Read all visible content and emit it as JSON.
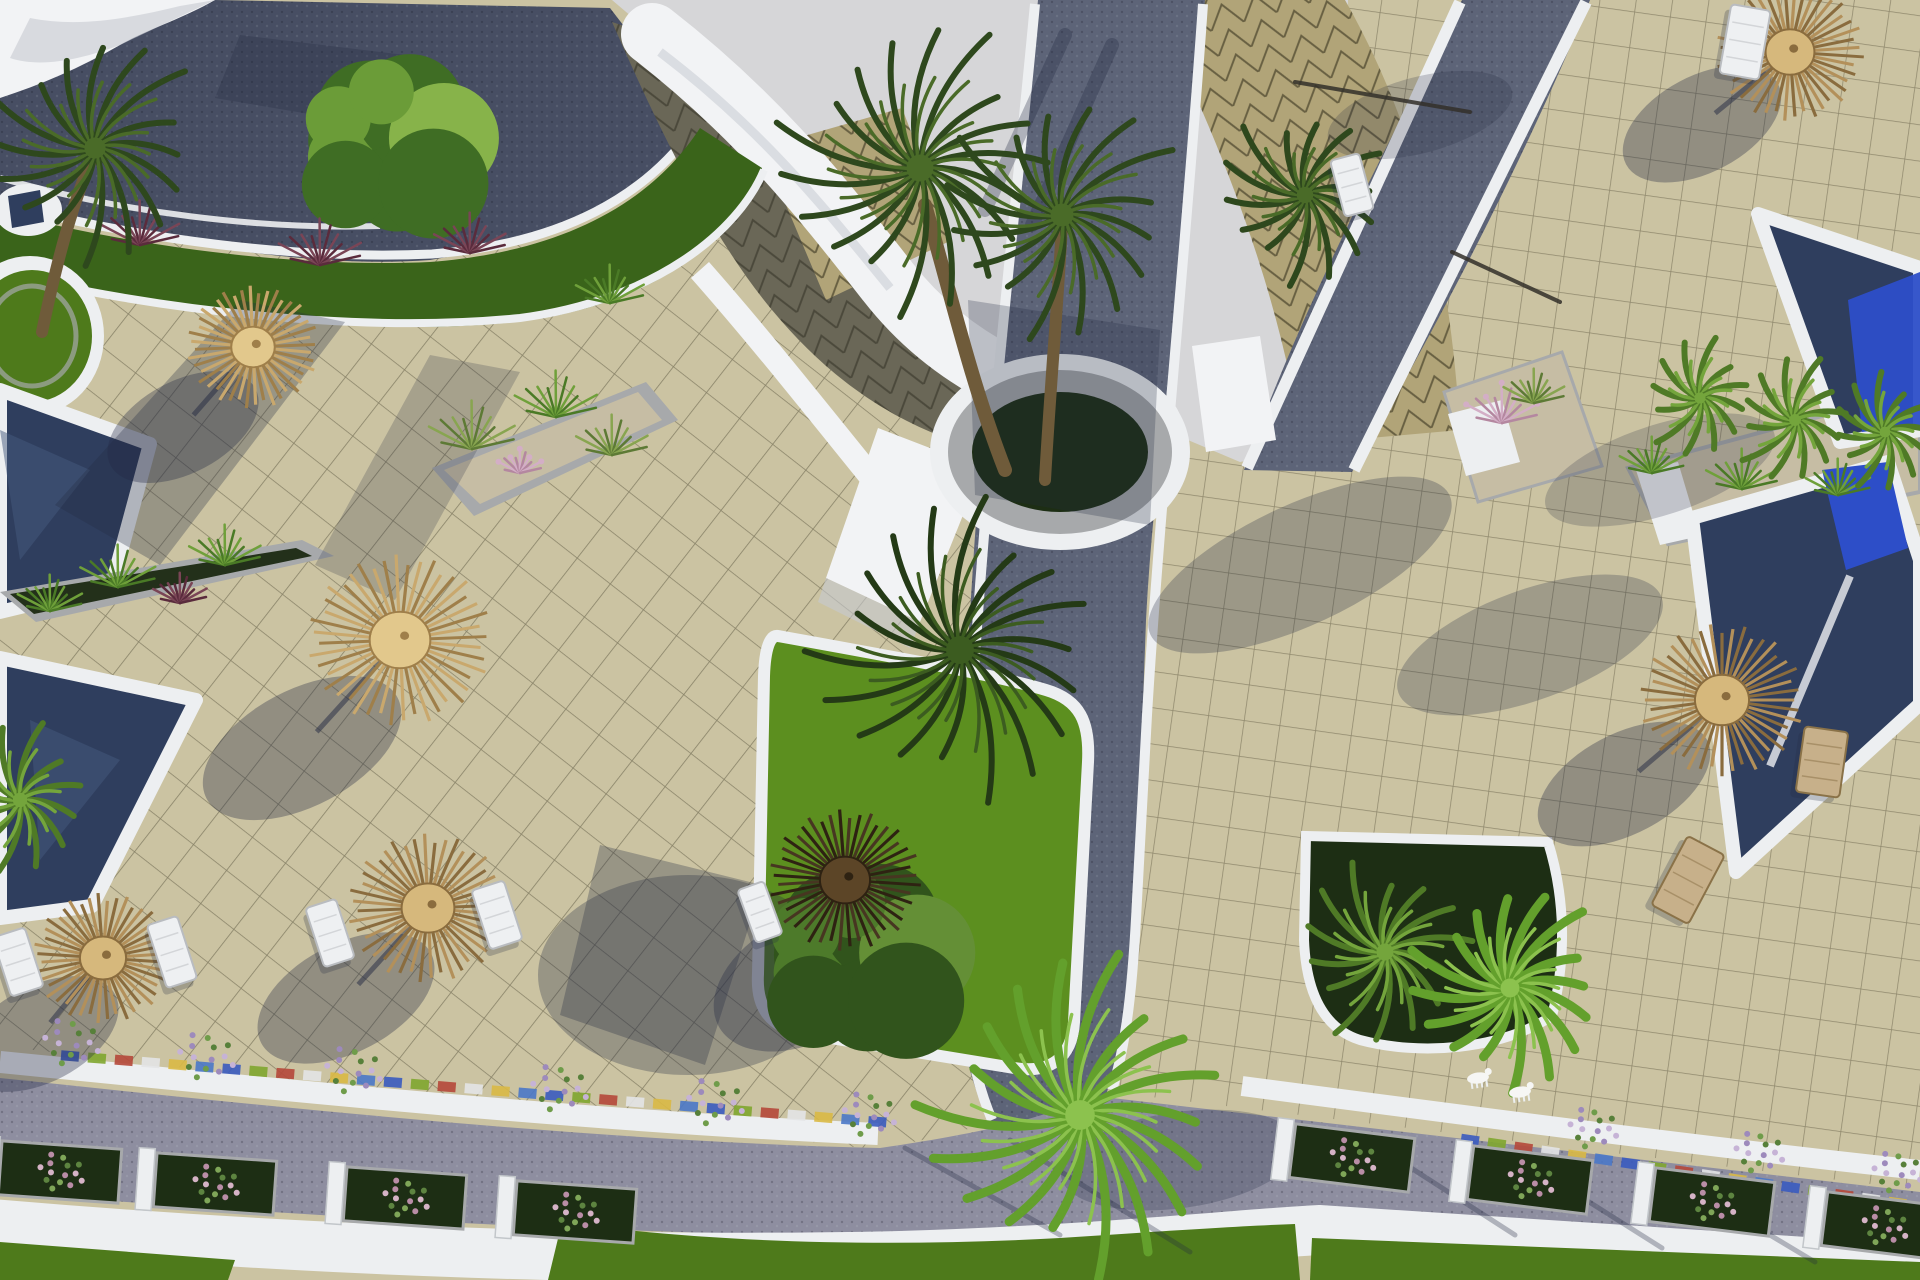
{
  "scene": {
    "description": "Aerial 3D architectural rendering of a resort: beige tiled pool terraces with thatched straw umbrellas and white sun loungers, navy swimming pools with white rims, curved white building roofs with tan triangle-patterned tiles, dark cobblestone pathways with white curbs, green lawns, planters with palms, ornamental grasses and flowering shrubs.",
    "palette": {
      "tile": "#cbc3a2",
      "sky": "#d6d6d8",
      "roadTop": "#474e63",
      "roadMid": "#5d6478",
      "roadLight": "#8e8ea0",
      "curb": "#edeff1",
      "whiteRoof": "#f2f3f5",
      "roofShade": "#c6cad1",
      "roofShadow": "#6a6757",
      "roofTan": "#b1a478",
      "stone": "#a7a9ab",
      "soil": "#23301a",
      "gravel": "#c6bda4",
      "lawn": "#4e7a1b",
      "lawnBright": "#5c8f1f",
      "grassStrip": "#3a641a",
      "bed": "#1d2e14",
      "poolNavy": "#2f3e5e",
      "poolBright": "#2d4ec8",
      "trunk": "#6f5b3a",
      "shadow": "#232a42"
    },
    "umbrella_tones": {
      "light": {
        "base": "#c9a86d",
        "alt": "#9f7f4a",
        "hub": "#e2c88c"
      },
      "mid": {
        "base": "#b3905a",
        "alt": "#8a6c3e",
        "hub": "#d6b87c"
      },
      "dark": {
        "base": "#473621",
        "alt": "#2e2212",
        "hub": "#5c4527"
      }
    },
    "umbrellas": [
      [
        253,
        347,
        66,
        "light",
        -70,
        80,
        82,
        46
      ],
      [
        400,
        640,
        92,
        "light",
        -98,
        108,
        108,
        58
      ],
      [
        103,
        958,
        70,
        "mid",
        -62,
        76,
        84,
        48
      ],
      [
        428,
        908,
        80,
        "mid",
        -82,
        90,
        96,
        54
      ],
      [
        845,
        880,
        76,
        "dark",
        -40,
        100,
        98,
        62
      ],
      [
        1790,
        52,
        74,
        "mid",
        -88,
        72,
        86,
        48
      ],
      [
        1722,
        700,
        82,
        "mid",
        -98,
        84,
        94,
        50
      ]
    ],
    "lounger_styles": {
      "white": {
        "fill": "#eef0f2",
        "stroke": "#b9bcc0"
      },
      "wood": {
        "fill": "#c7b08a",
        "stroke": "#8a7248"
      }
    },
    "loungers": [
      [
        18,
        962,
        34,
        62,
        -18,
        "white"
      ],
      [
        172,
        952,
        32,
        66,
        -18,
        "white"
      ],
      [
        330,
        933,
        32,
        62,
        -18,
        "white"
      ],
      [
        497,
        915,
        34,
        62,
        -18,
        "white"
      ],
      [
        760,
        912,
        28,
        56,
        -20,
        "white"
      ],
      [
        1352,
        185,
        30,
        58,
        -15,
        "white"
      ],
      [
        1745,
        42,
        40,
        70,
        10,
        "white"
      ],
      [
        1688,
        880,
        42,
        78,
        28,
        "wood"
      ],
      [
        1822,
        762,
        44,
        66,
        8,
        "wood"
      ]
    ],
    "palm_tones": {
      "dark": {
        "main": "#2e481d",
        "alt": "#4a6b28"
      },
      "deep": {
        "main": "#243a16",
        "alt": "#3c5c20"
      },
      "mid": {
        "main": "#4f7a26",
        "alt": "#74a53c"
      },
      "bright": {
        "main": "#63a02c",
        "alt": "#8cc24e"
      }
    },
    "palms": [
      [
        95,
        148,
        118,
        "dark",
        16
      ],
      [
        920,
        168,
        150,
        "dark",
        18
      ],
      [
        1062,
        215,
        128,
        "dark",
        16
      ],
      [
        1305,
        195,
        92,
        "dark",
        14
      ],
      [
        960,
        650,
        155,
        "deep",
        18
      ],
      [
        1080,
        1115,
        165,
        "bright",
        18
      ],
      [
        1385,
        952,
        95,
        "mid",
        14
      ],
      [
        1510,
        988,
        105,
        "bright",
        16
      ],
      [
        1700,
        398,
        62,
        "mid",
        12
      ],
      [
        1795,
        420,
        66,
        "mid",
        12
      ],
      [
        1885,
        432,
        60,
        "mid",
        12
      ],
      [
        20,
        800,
        80,
        "mid",
        12
      ]
    ],
    "trunks": [
      [
        "M1005,470 C970,380 950,290 925,205",
        14
      ],
      [
        "M1045,480 C1050,390 1058,300 1062,225",
        12
      ],
      [
        "M42,332 C55,270 70,210 92,158",
        12
      ]
    ],
    "tree_tones": {
      "mid": {
        "main": "#3f6d24",
        "alt": "#6b9c38",
        "hi": "#87b34a"
      },
      "deep": {
        "main": "#31541c",
        "alt": "#4d7a2a",
        "hi": "#648f36"
      }
    },
    "trees": [
      [
        385,
        145,
        125,
        "mid"
      ],
      [
        855,
        960,
        132,
        "deep"
      ]
    ],
    "tuft_colors": {
      "grass": [
        "#4a7a26",
        "#6fa03a"
      ],
      "reed": [
        "#5d7a35",
        "#88a550"
      ],
      "red": [
        "#5a2b3c",
        "#7a4556"
      ],
      "pink": [
        "#b487a0",
        "#d3aec6"
      ]
    },
    "tufts": [
      [
        118,
        584,
        42,
        "grass"
      ],
      [
        225,
        562,
        40,
        "grass"
      ],
      [
        50,
        608,
        36,
        "grass"
      ],
      [
        180,
        600,
        30,
        "red"
      ],
      [
        472,
        446,
        48,
        "reed"
      ],
      [
        556,
        414,
        46,
        "grass"
      ],
      [
        612,
        452,
        40,
        "reed"
      ],
      [
        520,
        470,
        24,
        "pink"
      ],
      [
        140,
        242,
        44,
        "red"
      ],
      [
        320,
        262,
        46,
        "red"
      ],
      [
        470,
        250,
        40,
        "red"
      ],
      [
        610,
        300,
        38,
        "grass"
      ],
      [
        1652,
        470,
        36,
        "grass"
      ],
      [
        1742,
        486,
        40,
        "grass"
      ],
      [
        1838,
        492,
        36,
        "grass"
      ],
      [
        1502,
        420,
        40,
        "pink"
      ],
      [
        1534,
        400,
        34,
        "reed"
      ]
    ],
    "flower_palette": [
      "#9d8abc",
      "#c6b3d6",
      "#57803a",
      "#6f9c4a"
    ],
    "flower_clusters": [
      [
        70,
        1042,
        30
      ],
      [
        205,
        1056,
        30
      ],
      [
        352,
        1070,
        30
      ],
      [
        558,
        1088,
        30
      ],
      [
        714,
        1102,
        30
      ],
      [
        868,
        1114,
        28
      ],
      [
        1592,
        1128,
        26
      ],
      [
        1758,
        1152,
        26
      ],
      [
        1896,
        1172,
        26
      ]
    ],
    "box_flower_palette": [
      "#b98da6",
      "#d5b3c6",
      "#5d8440",
      "#7fa658"
    ],
    "box_planters": {
      "left": [
        [
          60,
          1172
        ],
        [
          215,
          1184
        ],
        [
          405,
          1198
        ],
        [
          575,
          1212
        ]
      ],
      "left_rot": 4,
      "right": [
        [
          1352,
          1158
        ],
        [
          1530,
          1180
        ],
        [
          1712,
          1202
        ],
        [
          1884,
          1226
        ]
      ],
      "right_rot": 7,
      "box": [
        120,
        54
      ]
    },
    "mosaic": {
      "bands": [
        [
          70,
          1056,
          880,
          1122
        ],
        [
          1470,
          1140,
          1918,
          1206
        ]
      ],
      "colors": [
        "#3a5bbf",
        "#7fa62f",
        "#b5483a",
        "#e3e4e6",
        "#d9b945",
        "#4a78c8"
      ],
      "tile": [
        18,
        10
      ],
      "step": 27
    },
    "statues": [
      [
        1478,
        1078
      ],
      [
        1520,
        1092
      ]
    ],
    "sticks": [
      [
        1295,
        82,
        1470,
        112
      ],
      [
        1452,
        252,
        1560,
        302
      ]
    ],
    "shadows": {
      "ellipses": [
        [
          688,
          975,
          150,
          100,
          0,
          0.3
        ],
        [
          1300,
          565,
          165,
          60,
          -25,
          0.28
        ],
        [
          1530,
          645,
          140,
          55,
          -20,
          0.26
        ],
        [
          1420,
          115,
          95,
          38,
          -15,
          0.22
        ],
        [
          1660,
          470,
          120,
          45,
          -18,
          0.22
        ],
        [
          1180,
          1160,
          120,
          48,
          -8,
          0.25
        ]
      ],
      "polys": [
        [
          "240,300 345,322 160,565 55,505",
          0.3
        ],
        [
          "430,355 520,372 395,600 315,565",
          0.22
        ],
        [
          "600,845 762,885 705,1065 560,1015",
          0.3
        ],
        [
          "968,300 1160,330 1150,525 975,495",
          0.26
        ],
        [
          "240,35 430,58 392,128 215,98",
          0.28
        ]
      ],
      "lines": [
        [
          1065,
          35,
          985,
          210,
          14,
          0.3
        ],
        [
          1112,
          45,
          1032,
          225,
          14,
          0.3
        ],
        [
          905,
          1148,
          1060,
          1235,
          5,
          0.3
        ],
        [
          1010,
          1140,
          1190,
          1252,
          5,
          0.3
        ],
        [
          1360,
          1135,
          1515,
          1235,
          5,
          0.3
        ],
        [
          1510,
          1152,
          1662,
          1248,
          5,
          0.3
        ],
        [
          1665,
          1172,
          1815,
          1262,
          5,
          0.3
        ]
      ]
    }
  }
}
